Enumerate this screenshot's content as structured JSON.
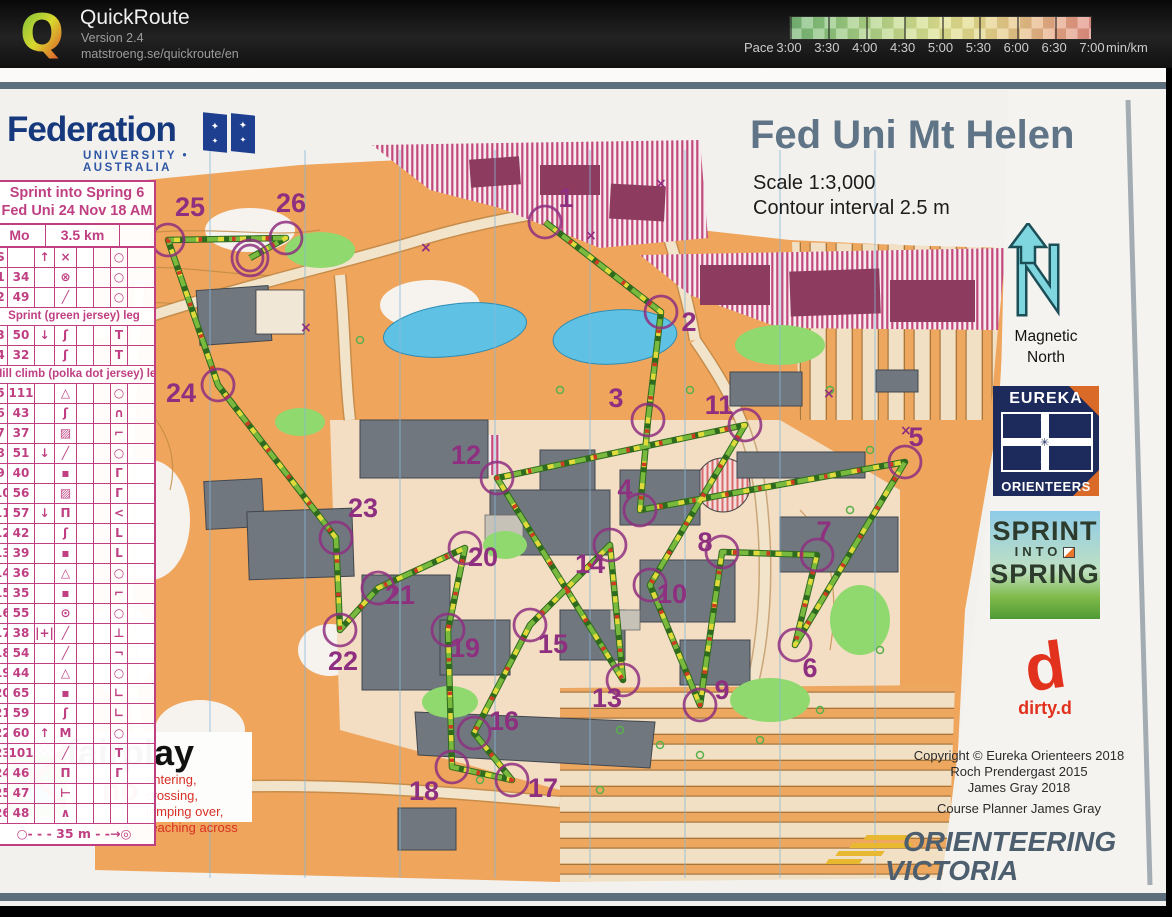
{
  "header": {
    "logo_letter": "Q",
    "app_name": "QuickRoute",
    "version": "Version 2.4",
    "url": "matstroeng.se/quickroute/en"
  },
  "pace_legend": {
    "prefix": "Pace",
    "labels": [
      "3:00",
      "3:30",
      "4:00",
      "4:30",
      "5:00",
      "5:30",
      "6:00",
      "6:30",
      "7:00"
    ],
    "unit": "min/km",
    "colors": [
      "#74b474",
      "#8cc47c",
      "#aad084",
      "#c8dc8c",
      "#dde08e",
      "#e4d88a",
      "#e6c486",
      "#e6a883",
      "#e18e82"
    ]
  },
  "map": {
    "title": "Fed Uni Mt Helen",
    "scale": "Scale 1:3,000",
    "contour": "Contour interval 2.5 m",
    "magnetic_north": "Magnetic North",
    "control_color": "#8e2f80",
    "controls": [
      {
        "n": "1",
        "x": 545,
        "y": 132,
        "lx": 566,
        "ly": 108
      },
      {
        "n": "2",
        "x": 661,
        "y": 222,
        "lx": 689,
        "ly": 232
      },
      {
        "n": "3",
        "x": 648,
        "y": 330,
        "lx": 616,
        "ly": 308
      },
      {
        "n": "4",
        "x": 640,
        "y": 420,
        "lx": 625,
        "ly": 399
      },
      {
        "n": "5",
        "x": 905,
        "y": 372,
        "lx": 916,
        "ly": 347
      },
      {
        "n": "6",
        "x": 795,
        "y": 555,
        "lx": 810,
        "ly": 578
      },
      {
        "n": "7",
        "x": 817,
        "y": 465,
        "lx": 824,
        "ly": 441
      },
      {
        "n": "8",
        "x": 722,
        "y": 462,
        "lx": 705,
        "ly": 452
      },
      {
        "n": "9",
        "x": 700,
        "y": 615,
        "lx": 722,
        "ly": 600
      },
      {
        "n": "10",
        "x": 650,
        "y": 495,
        "lx": 672,
        "ly": 504
      },
      {
        "n": "11",
        "x": 745,
        "y": 335,
        "lx": 719,
        "ly": 315
      },
      {
        "n": "12",
        "x": 497,
        "y": 388,
        "lx": 466,
        "ly": 365
      },
      {
        "n": "13",
        "x": 623,
        "y": 590,
        "lx": 607,
        "ly": 608
      },
      {
        "n": "14",
        "x": 610,
        "y": 455,
        "lx": 590,
        "ly": 474
      },
      {
        "n": "15",
        "x": 530,
        "y": 535,
        "lx": 553,
        "ly": 554
      },
      {
        "n": "16",
        "x": 474,
        "y": 643,
        "lx": 504,
        "ly": 631
      },
      {
        "n": "17",
        "x": 512,
        "y": 690,
        "lx": 543,
        "ly": 698
      },
      {
        "n": "18",
        "x": 452,
        "y": 677,
        "lx": 424,
        "ly": 701
      },
      {
        "n": "19",
        "x": 448,
        "y": 540,
        "lx": 465,
        "ly": 558
      },
      {
        "n": "20",
        "x": 465,
        "y": 458,
        "lx": 483,
        "ly": 467
      },
      {
        "n": "21",
        "x": 378,
        "y": 498,
        "lx": 400,
        "ly": 505
      },
      {
        "n": "22",
        "x": 340,
        "y": 540,
        "lx": 343,
        "ly": 571
      },
      {
        "n": "23",
        "x": 336,
        "y": 448,
        "lx": 363,
        "ly": 418
      },
      {
        "n": "24",
        "x": 218,
        "y": 295,
        "lx": 181,
        "ly": 303
      },
      {
        "n": "25",
        "x": 168,
        "y": 150,
        "lx": 190,
        "ly": 117
      },
      {
        "n": "26",
        "x": 286,
        "y": 148,
        "lx": 291,
        "ly": 113
      }
    ],
    "finish": {
      "x": 250,
      "y": 168
    },
    "route": [
      [
        545,
        132
      ],
      [
        661,
        222
      ],
      [
        648,
        330
      ],
      [
        640,
        420
      ],
      [
        905,
        372
      ],
      [
        795,
        555
      ],
      [
        817,
        465
      ],
      [
        722,
        462
      ],
      [
        700,
        615
      ],
      [
        650,
        495
      ],
      [
        745,
        335
      ],
      [
        497,
        388
      ],
      [
        623,
        590
      ],
      [
        610,
        455
      ],
      [
        530,
        535
      ],
      [
        474,
        643
      ],
      [
        512,
        690
      ],
      [
        452,
        677
      ],
      [
        448,
        540
      ],
      [
        465,
        458
      ],
      [
        378,
        498
      ],
      [
        340,
        540
      ],
      [
        336,
        448
      ],
      [
        218,
        295
      ],
      [
        168,
        150
      ],
      [
        286,
        148
      ],
      [
        250,
        168
      ]
    ]
  },
  "logos": {
    "federation": {
      "name": "Federation",
      "sub": "UNIVERSITY • AUSTRALIA"
    },
    "eureka": {
      "top": "EUREKA",
      "bottom": "ORIENTEERS"
    },
    "sprint": {
      "l1": "SPRINT",
      "l2": "INTO",
      "l3": "SPRING"
    },
    "dirtyd": {
      "letter": "d",
      "label": "dirty.d"
    },
    "ov": {
      "l1": "ORIENTEERING",
      "l2": "VICTORIA"
    }
  },
  "copyright": {
    "lines": [
      "Copyright © Eureka Orienteers 2018",
      "Roch Prendergast 2015",
      "James Gray 2018"
    ],
    "planner": "Course Planner James Gray"
  },
  "control_sheet": {
    "title1": "Sprint into Spring 6",
    "title2": "Fed Uni 24 Nov 18 AM",
    "course": "Mo",
    "length": "3.5 km",
    "rows": [
      {
        "s": "S",
        "c": "",
        "d": "↑",
        "f": "×",
        "p": "○"
      },
      {
        "s": "1",
        "c": "34",
        "d": "",
        "f": "⊗",
        "p": "○"
      },
      {
        "s": "2",
        "c": "49",
        "d": "",
        "f": "╱",
        "p": "○"
      },
      {
        "leg": "Sprint (green jersey) leg"
      },
      {
        "s": "3",
        "c": "50",
        "d": "↓",
        "f": "ʃ",
        "p": "Τ"
      },
      {
        "s": "4",
        "c": "32",
        "d": "",
        "f": "ʃ",
        "p": "Τ"
      },
      {
        "leg": "Hill climb (polka dot jersey) leg"
      },
      {
        "s": "5",
        "c": "111",
        "d": "",
        "f": "△",
        "p": "○"
      },
      {
        "s": "6",
        "c": "43",
        "d": "",
        "f": "ʃ",
        "p": "∩"
      },
      {
        "s": "7",
        "c": "37",
        "d": "",
        "f": "▨",
        "p": "⌐"
      },
      {
        "s": "8",
        "c": "51",
        "d": "↓",
        "f": "╱",
        "p": "○"
      },
      {
        "s": "9",
        "c": "40",
        "d": "",
        "f": "▪",
        "p": "Γ"
      },
      {
        "s": "10",
        "c": "56",
        "d": "",
        "f": "▨",
        "p": "Γ"
      },
      {
        "s": "11",
        "c": "57",
        "d": "↓",
        "f": "Π",
        "p": "<"
      },
      {
        "s": "12",
        "c": "42",
        "d": "",
        "f": "ʃ",
        "p": "L"
      },
      {
        "s": "13",
        "c": "39",
        "d": "",
        "f": "▪",
        "p": "L"
      },
      {
        "s": "14",
        "c": "36",
        "d": "",
        "f": "△",
        "p": "○"
      },
      {
        "s": "15",
        "c": "35",
        "d": "",
        "f": "▪",
        "p": "⌐"
      },
      {
        "s": "16",
        "c": "55",
        "d": "",
        "f": "⊙",
        "p": "○"
      },
      {
        "s": "17",
        "c": "38",
        "d": "|+|",
        "f": "╱",
        "p": "⊥"
      },
      {
        "s": "18",
        "c": "54",
        "d": "",
        "f": "╱",
        "p": "¬"
      },
      {
        "s": "19",
        "c": "44",
        "d": "",
        "f": "△",
        "p": "○"
      },
      {
        "s": "20",
        "c": "65",
        "d": "",
        "f": "▪",
        "p": "∟"
      },
      {
        "s": "21",
        "c": "59",
        "d": "",
        "f": "ʃ",
        "p": "∟"
      },
      {
        "s": "22",
        "c": "60",
        "d": "↑",
        "f": "M",
        "p": "○"
      },
      {
        "s": "23",
        "c": "101",
        "d": "",
        "f": "╱",
        "p": "Τ"
      },
      {
        "s": "24",
        "c": "46",
        "d": "",
        "f": "Π",
        "p": "Γ"
      },
      {
        "s": "25",
        "c": "47",
        "d": "",
        "f": "⊢",
        "p": ""
      },
      {
        "s": "26",
        "c": "48",
        "d": "",
        "f": "∧",
        "p": ""
      }
    ],
    "finish_text": "○- - -  35 m  - -→◎"
  },
  "fairplay": {
    "title": "fairplay",
    "no_word": "no",
    "line1": "entering, crossing,",
    "line2": "jumping over,",
    "line3": "reaching across"
  }
}
